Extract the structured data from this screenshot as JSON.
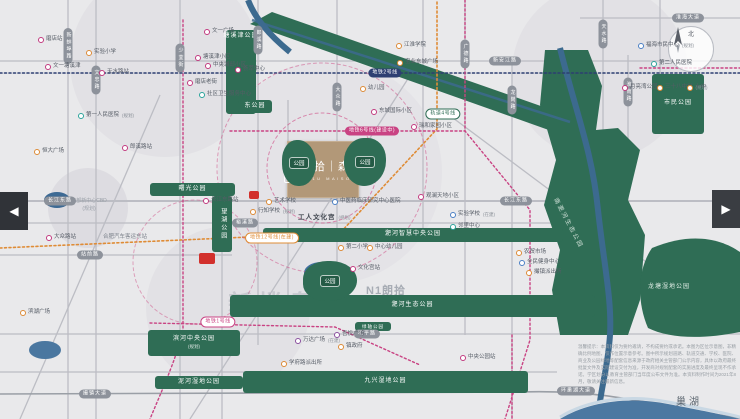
{
  "brand": {
    "mark": "N1",
    "name": "朗拾｜森屿",
    "name_en": "N1U MAISON",
    "watermark_logo": "N1朗拾",
    "watermark_sub": "MAISON"
  },
  "compass_label": "北",
  "lake_label": "巢湖",
  "watermark_center": "新楼盘网",
  "cbd_circle": {
    "line1": "东部新中心CBD",
    "line2": "(规划)"
  },
  "carousel": {
    "prev": "◀",
    "next": "▶"
  },
  "labels": {
    "river_park": "南淝河生态公园",
    "longtang_park": "龙塘湿地公园"
  },
  "disclaimer": "温馨提示：本资料仅为要约邀请，不构成要约或承诺。本图为区位示意图，非精确比例地图，仅作位置示意参考。图中所示规划道路、轨道交通、学校、医院、商业及公园绿地等配套信息来源于政府相关主管部门公示内容，具体以政府最终批复文件及实际建设交付为准，开发商对规划配套的实施进度及最终呈现不作承诺。学区划分以教育主管部门当年度公布文件为准。本资料制作时间为2021年8月，敬请关注最新信息。",
  "parks": [
    {
      "label": "塘溪津公园",
      "x": 226,
      "y": 30,
      "w": 30,
      "h": 84,
      "top": true
    },
    {
      "label": "东公园",
      "x": 238,
      "y": 100,
      "w": 34,
      "h": 13
    },
    {
      "label": "市民公园",
      "x": 652,
      "y": 74,
      "w": 52,
      "h": 60
    },
    {
      "label": "曙光公园",
      "x": 150,
      "y": 183,
      "w": 85,
      "h": 13
    },
    {
      "label": "望湖公园",
      "x": 212,
      "y": 196,
      "w": 20,
      "h": 56,
      "vertical": true
    },
    {
      "label": "公园",
      "x": 282,
      "y": 140,
      "w": 34,
      "h": 46,
      "pill": true,
      "r": "45% 55% 50% 50%"
    },
    {
      "label": "公园",
      "x": 344,
      "y": 138,
      "w": 42,
      "h": 48,
      "pill": true,
      "r": "50% 45% 55% 50%"
    },
    {
      "label": "淝河智慧中央公园",
      "x": 263,
      "y": 228,
      "w": 300,
      "h": 14
    },
    {
      "label": "淝河生态公园",
      "x": 230,
      "y": 295,
      "w": 365,
      "h": 22
    },
    {
      "label": "公园",
      "x": 303,
      "y": 261,
      "w": 54,
      "h": 40,
      "pill": true,
      "r": "48% 52% 55% 45%"
    },
    {
      "label": "滨河中央公园",
      "sub": "(规划)",
      "x": 148,
      "y": 330,
      "w": 92,
      "h": 26
    },
    {
      "label": "泥河湿地公园",
      "x": 155,
      "y": 376,
      "w": 88,
      "h": 13
    },
    {
      "label": "九兴湿地公园",
      "x": 243,
      "y": 371,
      "w": 285,
      "h": 22
    },
    {
      "label": "绿轴公园",
      "x": 355,
      "y": 322,
      "w": 36,
      "h": 9,
      "small": true
    }
  ],
  "road_pills": [
    {
      "label": "新蚌埠路",
      "x": 68,
      "y": 46,
      "v": true
    },
    {
      "label": "文忠路",
      "x": 96,
      "y": 80,
      "v": true
    },
    {
      "label": "少荃街",
      "x": 180,
      "y": 58,
      "v": true
    },
    {
      "label": "郎溪路",
      "x": 258,
      "y": 40,
      "v": true
    },
    {
      "label": "大众路",
      "x": 337,
      "y": 97,
      "v": true
    },
    {
      "label": "广德路",
      "x": 465,
      "y": 54,
      "v": true
    },
    {
      "label": "龙岗路",
      "x": 512,
      "y": 100,
      "v": true
    },
    {
      "label": "天水路",
      "x": 603,
      "y": 34,
      "v": true
    },
    {
      "label": "淮南路",
      "x": 628,
      "y": 92,
      "v": true
    },
    {
      "label": "新安江路",
      "x": 505,
      "y": 61
    },
    {
      "label": "淮海大道",
      "x": 688,
      "y": 18
    },
    {
      "label": "长江东路",
      "x": 60,
      "y": 201
    },
    {
      "label": "长江东路",
      "x": 516,
      "y": 201
    },
    {
      "label": "裕溪路",
      "x": 245,
      "y": 223
    },
    {
      "label": "站前路",
      "x": 90,
      "y": 255
    },
    {
      "label": "和平路",
      "x": 367,
      "y": 334
    },
    {
      "label": "撮镇大道",
      "x": 95,
      "y": 394
    },
    {
      "label": "环巢湖大道",
      "x": 576,
      "y": 391
    }
  ],
  "metro_pills": [
    {
      "label": "地铁2号线",
      "x": 385,
      "y": 73,
      "style": "navy"
    },
    {
      "label": "地铁6号线(建设中)",
      "x": 372,
      "y": 131,
      "style": "magenta"
    },
    {
      "label": "地铁12号线(在建)",
      "x": 272,
      "y": 238,
      "style": "orangeOutline"
    },
    {
      "label": "地铁1号线",
      "x": 218,
      "y": 322,
      "style": "magentaOutline"
    },
    {
      "label": "轨道4号线",
      "x": 443,
      "y": 114,
      "style": "greenOutline"
    }
  ],
  "pois": [
    {
      "x": 40,
      "y": 40,
      "c": "magenta",
      "t": "磨店站"
    },
    {
      "x": 88,
      "y": 53,
      "c": "orange",
      "t": "实验小学"
    },
    {
      "x": 47,
      "y": 67,
      "c": "magenta",
      "t": "文一塘溪津"
    },
    {
      "x": 101,
      "y": 73,
      "c": "magenta",
      "t": "天水路站"
    },
    {
      "x": 80,
      "y": 116,
      "c": "teal",
      "t": "第一人民医院",
      "s": "(规划)"
    },
    {
      "x": 36,
      "y": 152,
      "c": "orange",
      "t": "恒大广场"
    },
    {
      "x": 124,
      "y": 148,
      "c": "magenta",
      "t": "郎溪路站"
    },
    {
      "x": 206,
      "y": 32,
      "c": "magenta",
      "t": "文一广场"
    },
    {
      "x": 197,
      "y": 58,
      "c": "magenta",
      "t": "塘溪津小区"
    },
    {
      "x": 207,
      "y": 66,
      "c": "magenta",
      "t": "中央城邸小区"
    },
    {
      "x": 237,
      "y": 70,
      "c": "magenta",
      "t": "荟萃中心"
    },
    {
      "x": 189,
      "y": 83,
      "c": "magenta",
      "t": "磨店老街"
    },
    {
      "x": 201,
      "y": 95,
      "c": "teal",
      "t": "社区卫生服务中心"
    },
    {
      "x": 362,
      "y": 89,
      "c": "orange",
      "t": "幼儿园"
    },
    {
      "x": 398,
      "y": 46,
      "c": "orange",
      "t": "江淮学院"
    },
    {
      "x": 399,
      "y": 63,
      "c": "orange",
      "t": "宝业东城广场"
    },
    {
      "x": 373,
      "y": 112,
      "c": "magenta",
      "t": "东城国际小区"
    },
    {
      "x": 413,
      "y": 127,
      "c": "magenta",
      "t": "瑞和家园小区"
    },
    {
      "x": 640,
      "y": 46,
      "c": "blue",
      "t": "福海市民中心",
      "s": "(规划)"
    },
    {
      "x": 653,
      "y": 64,
      "c": "teal",
      "t": "第二人民医院"
    },
    {
      "x": 659,
      "y": 88,
      "c": "orange",
      "t": "三十八中学",
      "s": "(规划)"
    },
    {
      "x": 689,
      "y": 88,
      "c": "orange",
      "t": "十中"
    },
    {
      "x": 624,
      "y": 88,
      "c": "magenta",
      "t": "月亮湾公园"
    },
    {
      "x": 205,
      "y": 201,
      "c": "magenta",
      "t": "长江东路站"
    },
    {
      "x": 268,
      "y": 202,
      "c": "orange",
      "t": "艺术学校"
    },
    {
      "x": 252,
      "y": 212,
      "c": "orange",
      "t": "行知学校",
      "s": "(规划)"
    },
    {
      "x": 334,
      "y": 202,
      "c": "blue",
      "t": "中医药临床研究中心医院"
    },
    {
      "x": 300,
      "y": 218,
      "type": "bold",
      "t": "工人文化宫",
      "s": "(规划)"
    },
    {
      "x": 340,
      "y": 248,
      "c": "orange",
      "t": "第二小学"
    },
    {
      "x": 369,
      "y": 248,
      "c": "orange",
      "t": "中心幼儿园"
    },
    {
      "x": 352,
      "y": 269,
      "c": "magenta",
      "t": "文化宫站"
    },
    {
      "x": 420,
      "y": 197,
      "c": "magenta",
      "t": "观澜天地小区"
    },
    {
      "x": 452,
      "y": 215,
      "c": "blue",
      "t": "实验学校",
      "s": "(在建)"
    },
    {
      "x": 452,
      "y": 227,
      "c": "teal",
      "t": "邻里中心"
    },
    {
      "x": 518,
      "y": 253,
      "c": "orange",
      "t": "农贸市场"
    },
    {
      "x": 521,
      "y": 263,
      "c": "blue",
      "t": "全民健身中心"
    },
    {
      "x": 528,
      "y": 273,
      "c": "orange",
      "t": "撮镇派出所"
    },
    {
      "x": 48,
      "y": 238,
      "c": "magenta",
      "t": "大众路站"
    },
    {
      "x": 105,
      "y": 238,
      "type": "gtext",
      "t": "合肥汽车客运东站"
    },
    {
      "x": 297,
      "y": 341,
      "c": "purple",
      "t": "万达广场",
      "s": "(在建)"
    },
    {
      "x": 336,
      "y": 335,
      "c": "purple",
      "t": "吾悦广场"
    },
    {
      "x": 283,
      "y": 364,
      "c": "orange",
      "t": "学府路派出所"
    },
    {
      "x": 340,
      "y": 347,
      "c": "orange",
      "t": "镇政府"
    },
    {
      "x": 22,
      "y": 313,
      "c": "orange",
      "t": "滨湖广场"
    },
    {
      "x": 462,
      "y": 358,
      "c": "magenta",
      "t": "中央公园站"
    }
  ],
  "markers": [
    {
      "x": 249,
      "y": 191,
      "w": 10,
      "h": 8
    },
    {
      "x": 199,
      "y": 253,
      "w": 16,
      "h": 11
    }
  ],
  "colors": {
    "magenta": "#c2397f",
    "orange": "#dd8a35",
    "teal": "#2aa39b",
    "blue": "#4a7fc4",
    "purple": "#8a4f9e",
    "red": "#d2302c",
    "green": "#2f6d55",
    "navy": "#2d3f72",
    "river": "#3c6a8f",
    "lake": "#4c78a1",
    "tan": "#b29878"
  }
}
